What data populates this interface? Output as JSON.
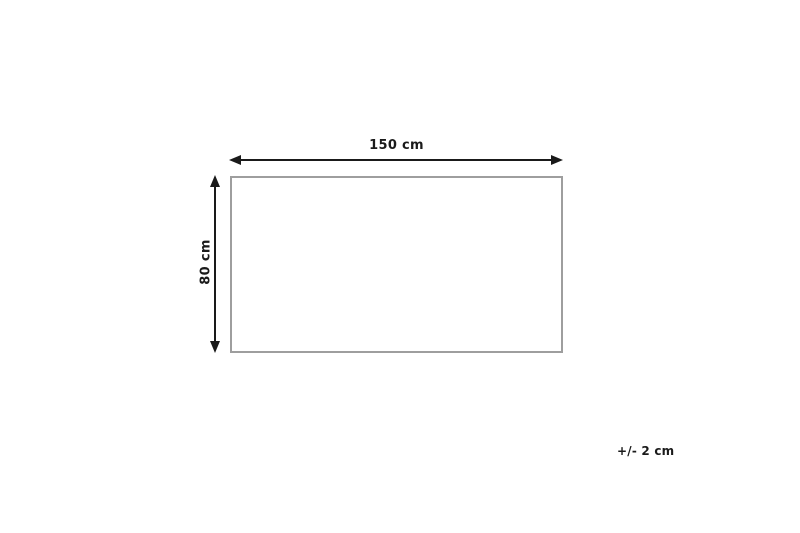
{
  "diagram": {
    "title": "product-dimensions-diagram",
    "width_label": "150 cm",
    "height_label": "80 cm",
    "tolerance_label": "+/- 2 cm",
    "colors": {
      "background": "#ffffff",
      "arrow": "#1a1a1a",
      "text": "#1a1a1a",
      "rectangle_border": "#9e9e9e"
    }
  }
}
